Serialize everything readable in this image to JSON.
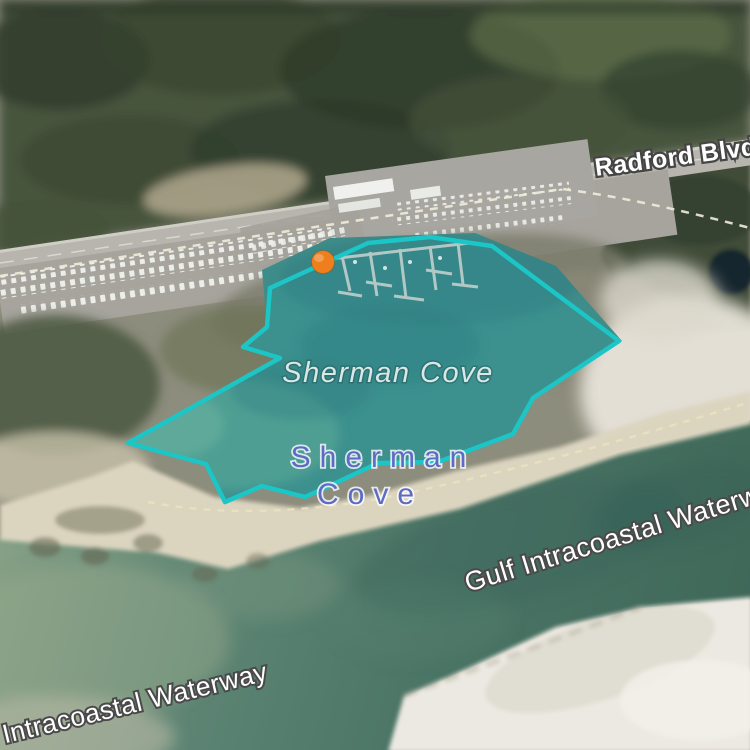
{
  "view": {
    "type": "satellite-map",
    "description": "Aerial imagery of Sherman Cove marina area with drawn boundary annotation"
  },
  "labels": {
    "road": "Radford Blvd",
    "cove_area": "Sherman Cove",
    "water_body_line1": "Sherman",
    "water_body_line2": "Cove",
    "waterway_right": "Gulf Intracoastal Waterway",
    "waterway_bottom": "Gulf Intracoastal Waterway"
  },
  "annotation": {
    "polygon_points": "128,443 280,358 243,347 267,327 270,288 368,243 430,237 492,246 619,341 533,398 513,434 438,462 378,463 340,481 305,497 262,486 225,502 206,464",
    "polygon_stroke": "#1cc6c6",
    "polygon_fill": "rgba(28,198,198,0.07)",
    "marker_color": "#ef7f1c",
    "marker_x": "323",
    "marker_y": "262"
  },
  "colors": {
    "annotation_teal": "#1cc6c6",
    "marker_orange": "#ef7f1c",
    "cove_water": "#3f8d8a",
    "waterway_water": "#4d7467",
    "forest_green": "#46543d",
    "road_gray": "#b7b5ae",
    "sand_light": "#ece9e2",
    "water_label_blue": "#5c6cc4",
    "map_label_white": "#ffffff",
    "cove_label_gray": "#d9e7e5"
  }
}
